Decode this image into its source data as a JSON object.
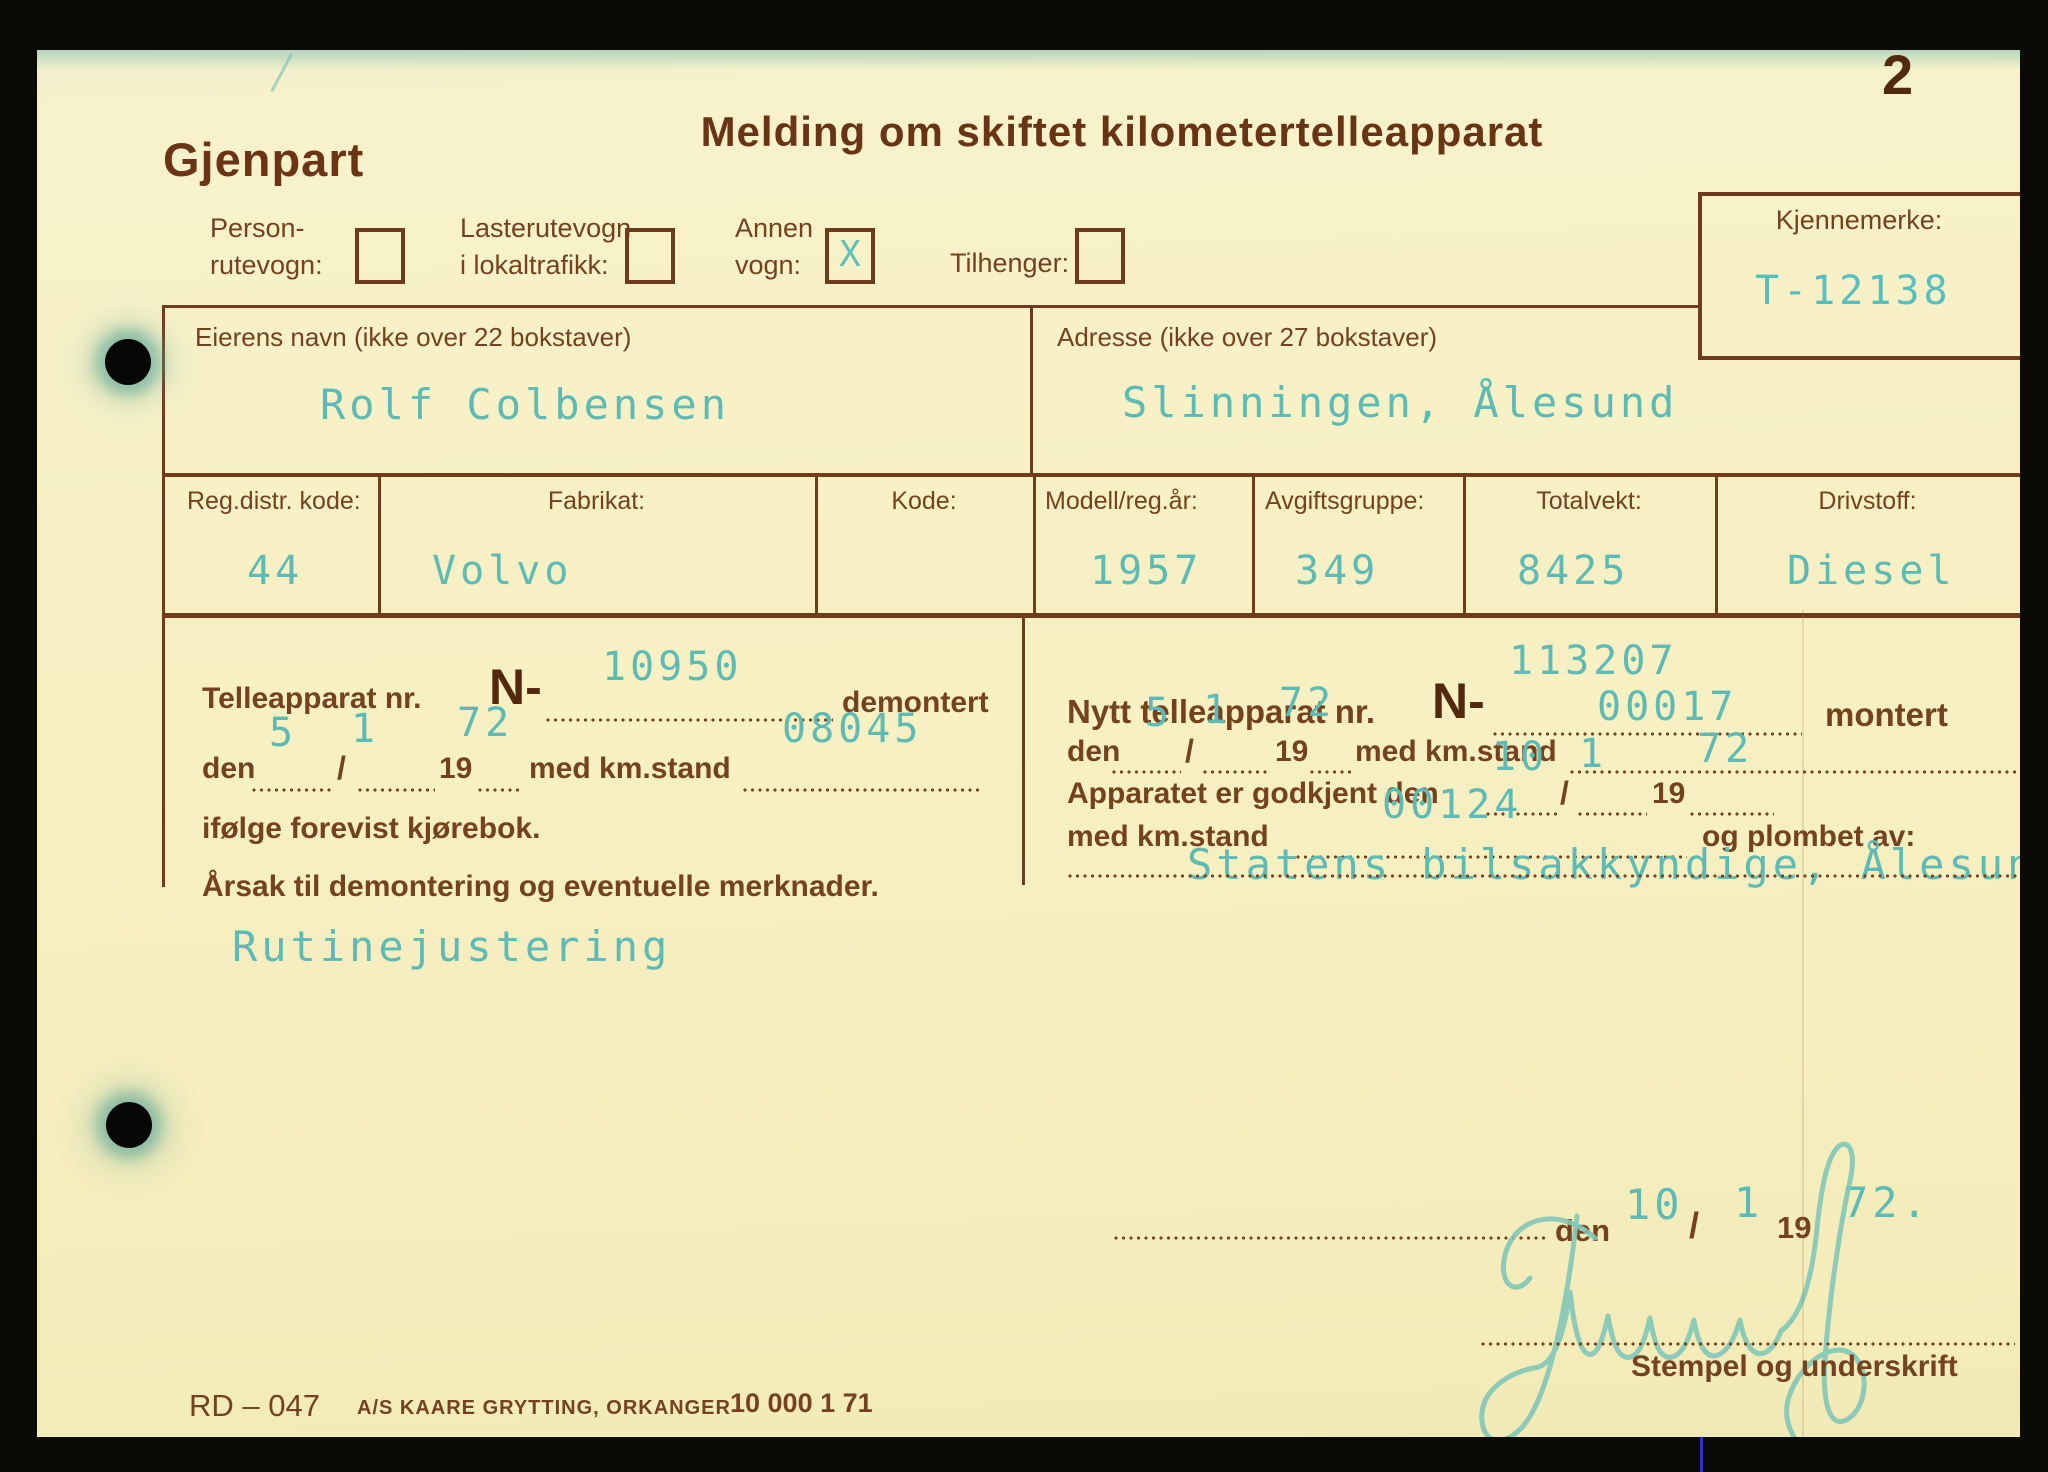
{
  "scan": {
    "page_number": "2"
  },
  "header": {
    "copy_label": "Gjenpart",
    "title": "Melding om skiftet kilometertelleapparat"
  },
  "vehicle_type": {
    "options": [
      {
        "line1": "Person-",
        "line2": "rutevogn:",
        "checked": false,
        "mark": ""
      },
      {
        "line1": "Lasterutevogn",
        "line2": "i lokaltrafikk:",
        "checked": false,
        "mark": ""
      },
      {
        "line1": "Annen",
        "line2": "vogn:",
        "checked": true,
        "mark": "X"
      },
      {
        "line1": "Tilhenger:",
        "line2": "",
        "checked": false,
        "mark": ""
      }
    ]
  },
  "plate": {
    "label": "Kjennemerke:",
    "value": "T-12138"
  },
  "owner": {
    "name_label": "Eierens navn (ikke over 22 bokstaver)",
    "name_value": "Rolf Colbensen",
    "address_label": "Adresse (ikke over 27 bokstaver)",
    "address_value": "Slinningen, Ålesund"
  },
  "vehicle_table": {
    "columns": [
      {
        "label": "Reg.distr. kode:",
        "value": "44"
      },
      {
        "label": "Fabrikat:",
        "value": "Volvo"
      },
      {
        "label": "Kode:",
        "value": ""
      },
      {
        "label": "Modell/reg.år:",
        "value": "1957"
      },
      {
        "label": "Avgiftsgruppe:",
        "value": "349"
      },
      {
        "label": "Totalvekt:",
        "value": "8425"
      },
      {
        "label": "Drivstoff:",
        "value": "Diesel"
      }
    ]
  },
  "removed": {
    "label_prefix": "Telleapparat nr.",
    "n_label": "N-",
    "label_suffix": "demontert",
    "apparat_nr": "10950",
    "den_label": "den",
    "slash": "/",
    "year_prefix": "19",
    "km_label": "med km.stand",
    "day": "5",
    "month": "1",
    "year": "72",
    "km_stand": "08045",
    "book_line": "ifølge forevist kjørebok.",
    "reason_label": "Årsak til demontering og eventuelle merknader.",
    "reason_value": "Rutinejustering"
  },
  "installed": {
    "label_prefix": "Nytt telleapparat nr.",
    "n_label": "N-",
    "label_suffix": "montert",
    "apparat_nr": "113207",
    "den_label": "den",
    "slash": "/",
    "year_prefix": "19",
    "km_label": "med km.stand",
    "day": "5",
    "month": "1",
    "year": "72",
    "km_stand": "00017",
    "approved_label": "Apparatet er godkjent den",
    "approved_day": "10",
    "approved_month": "1",
    "approved_year": "72",
    "km2_label": "med km.stand",
    "km_stand2": "00124",
    "sealed_label": "og plombet av:",
    "sealed_by": "Statens bilsakkyndige, Ålesund."
  },
  "signature_block": {
    "den_label": "den",
    "day": "10",
    "slash": "/",
    "month": "1",
    "year_prefix": "19",
    "year": "72.",
    "caption": "Stempel og underskrift"
  },
  "footer": {
    "form_code": "RD – 047",
    "printer": "A/S KAARE GRYTTING, ORKANGER",
    "edition": "10 000 1 71"
  }
}
